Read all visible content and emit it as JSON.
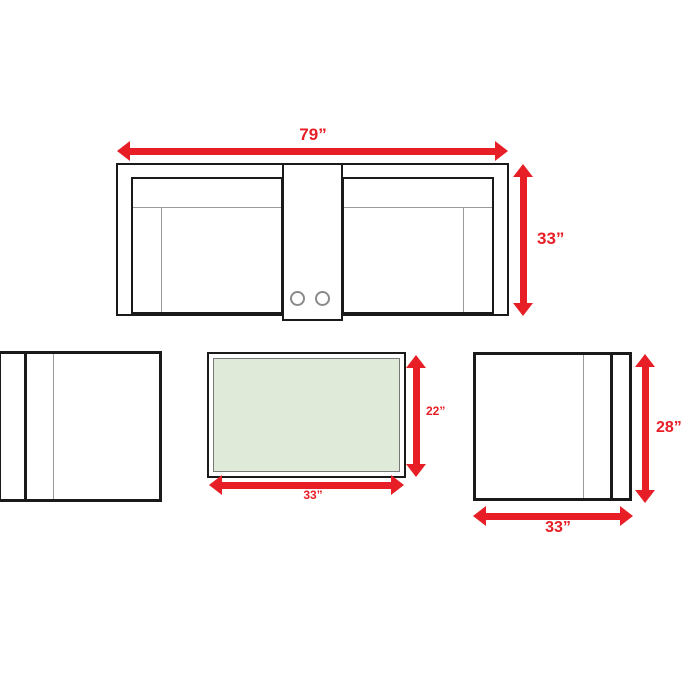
{
  "colors": {
    "accent": "#e81e26",
    "outline": "#1a1a1a",
    "muted": "#9a9a9a",
    "glass": "#e0ead8",
    "background": "#ffffff"
  },
  "diagram": {
    "description": "Furniture set dimensions diagram: sofa top view, two armchairs, coffee table",
    "sofa": {
      "width_label": "79”",
      "height_label": "33”"
    },
    "coffee_table": {
      "height_label": "22”",
      "width_label": "33”"
    },
    "armchair_right": {
      "height_label": "28”",
      "width_label": "33”"
    }
  }
}
